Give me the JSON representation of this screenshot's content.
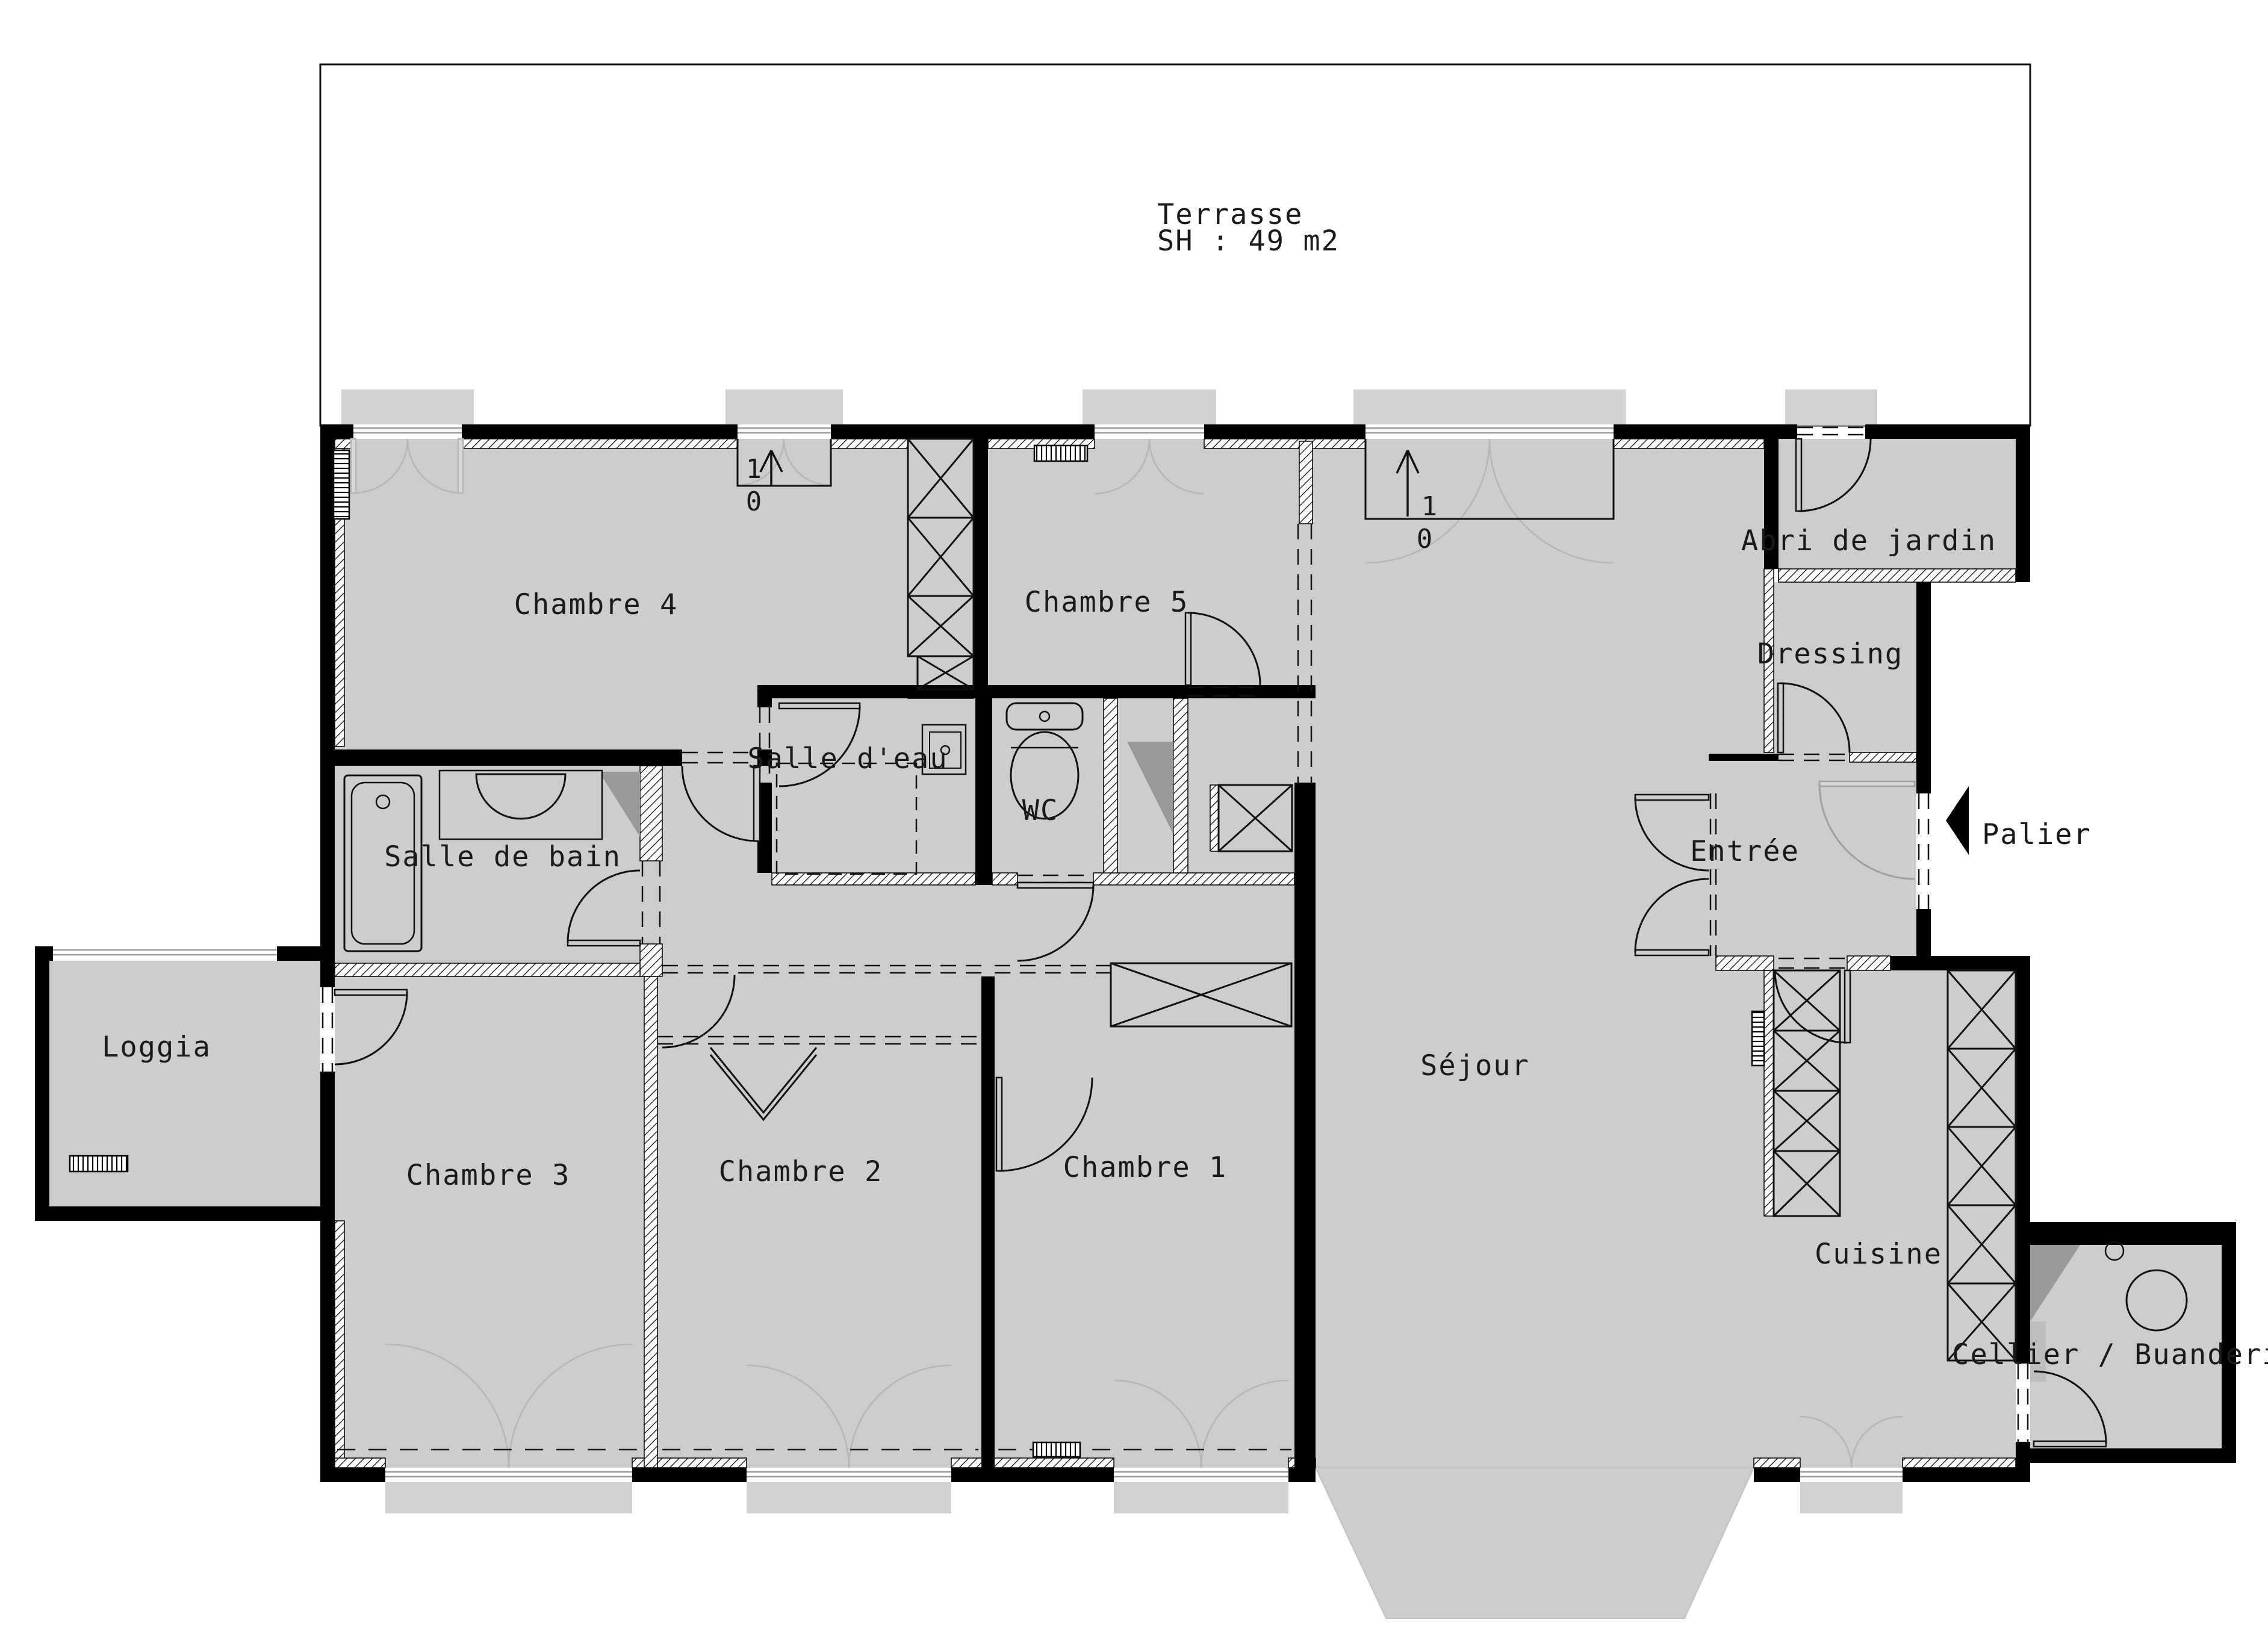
{
  "drawing": {
    "type": "apartment-floor-plan",
    "background_color": "#ffffff",
    "floor_color": "#cdcdcd",
    "wall_color": "#000000",
    "slope_shade_color": "#9a9a9a",
    "door_swing_color": "#b6b6b6"
  },
  "terrace": {
    "label": "Terrasse",
    "area": "SH : 49 m2"
  },
  "rooms": {
    "chambre4": {
      "label": "Chambre 4"
    },
    "chambre5": {
      "label": "Chambre 5"
    },
    "abri": {
      "label": "Abri de jardin"
    },
    "dressing": {
      "label": "Dressing"
    },
    "salle_eau": {
      "label": "Salle d'eau"
    },
    "wc": {
      "label": "WC"
    },
    "entree": {
      "label": "Entrée"
    },
    "salle_bain": {
      "label": "Salle de bain"
    },
    "loggia": {
      "label": "Loggia"
    },
    "chambre3": {
      "label": "Chambre 3"
    },
    "chambre2": {
      "label": "Chambre 2"
    },
    "chambre1": {
      "label": "Chambre 1"
    },
    "sejour": {
      "label": "Séjour"
    },
    "cuisine": {
      "label": "Cuisine"
    },
    "cellier": {
      "label": "Cellier / Buanderie"
    }
  },
  "landing": {
    "label": "Palier"
  },
  "stairs": [
    {
      "up": "1",
      "down": "0"
    },
    {
      "up": "1",
      "down": "0"
    }
  ]
}
